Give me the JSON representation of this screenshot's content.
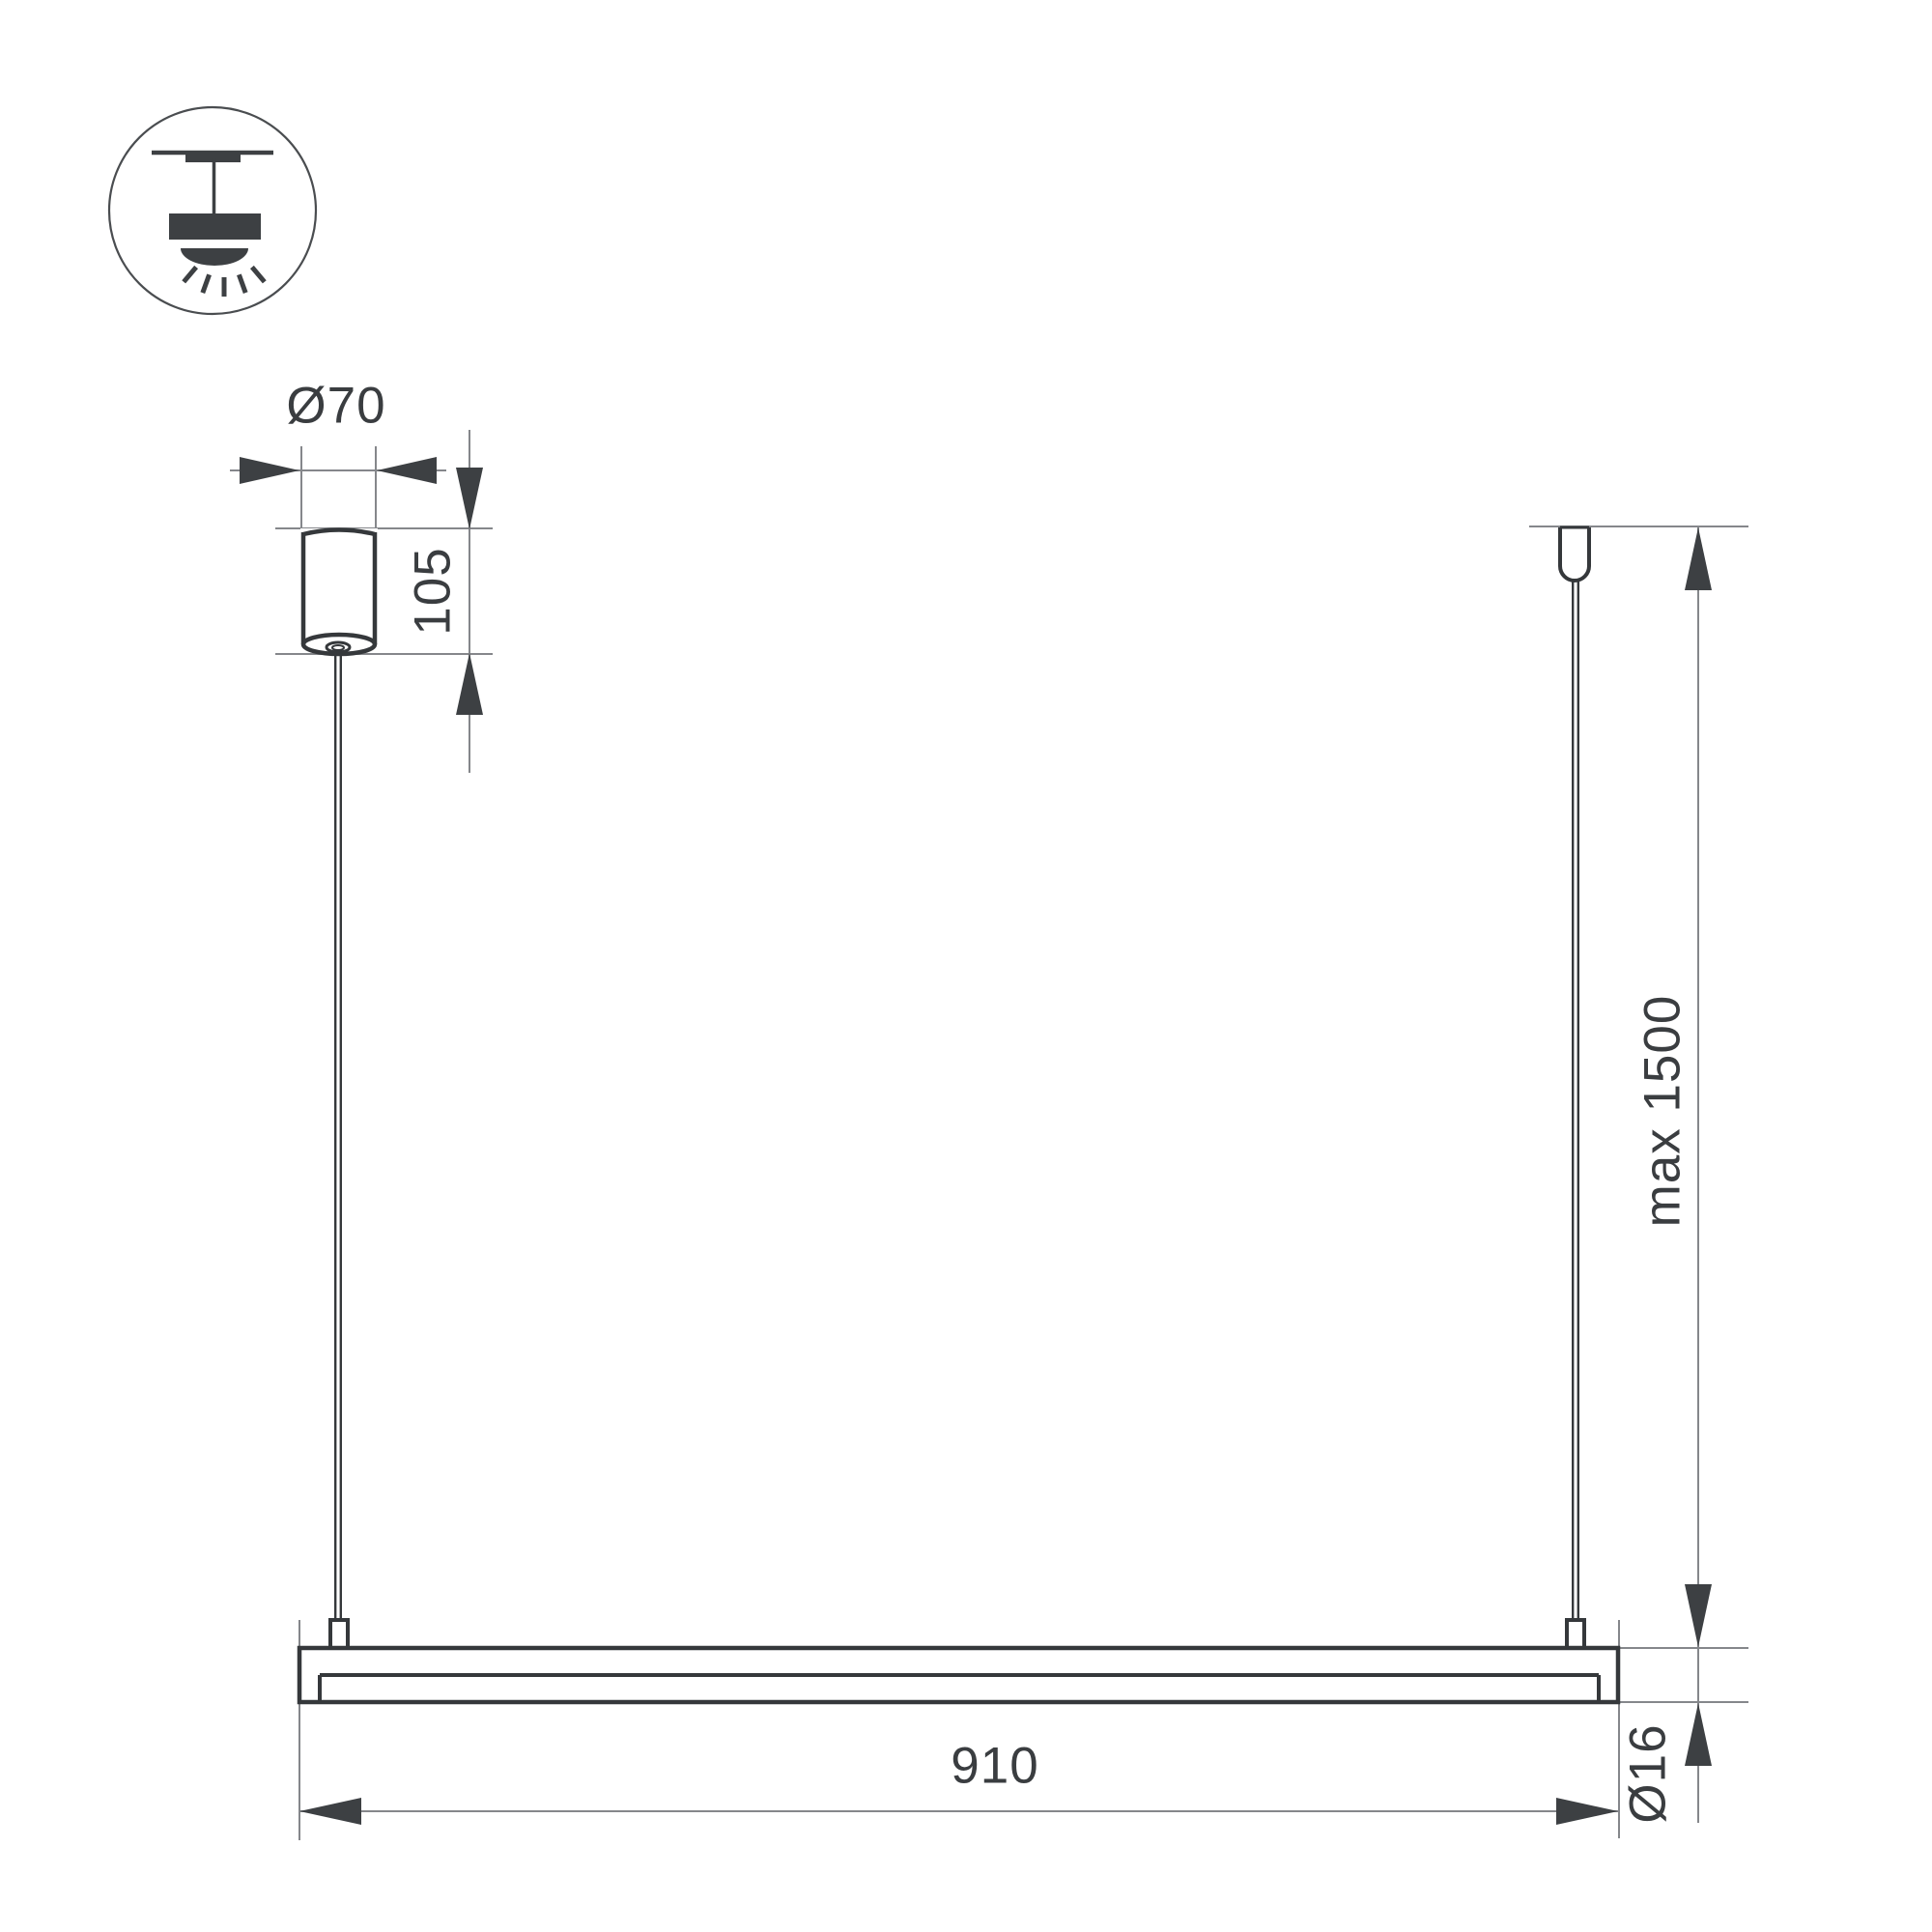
{
  "drawing": {
    "icon": {
      "name": "pendant-light-icon"
    },
    "dimension_labels": [
      {
        "id": "canopy-diameter",
        "text": "Ø70"
      },
      {
        "id": "canopy-height",
        "text": "105"
      },
      {
        "id": "max-suspension",
        "text": "max 1500"
      },
      {
        "id": "fixture-length",
        "text": "910"
      },
      {
        "id": "fixture-diameter",
        "text": "Ø16"
      }
    ],
    "colors": {
      "outline": "#35383b",
      "construction_line": "#85878b",
      "arrow": "#3d4043",
      "label": "#3a3d40",
      "background": "#ffffff"
    }
  }
}
